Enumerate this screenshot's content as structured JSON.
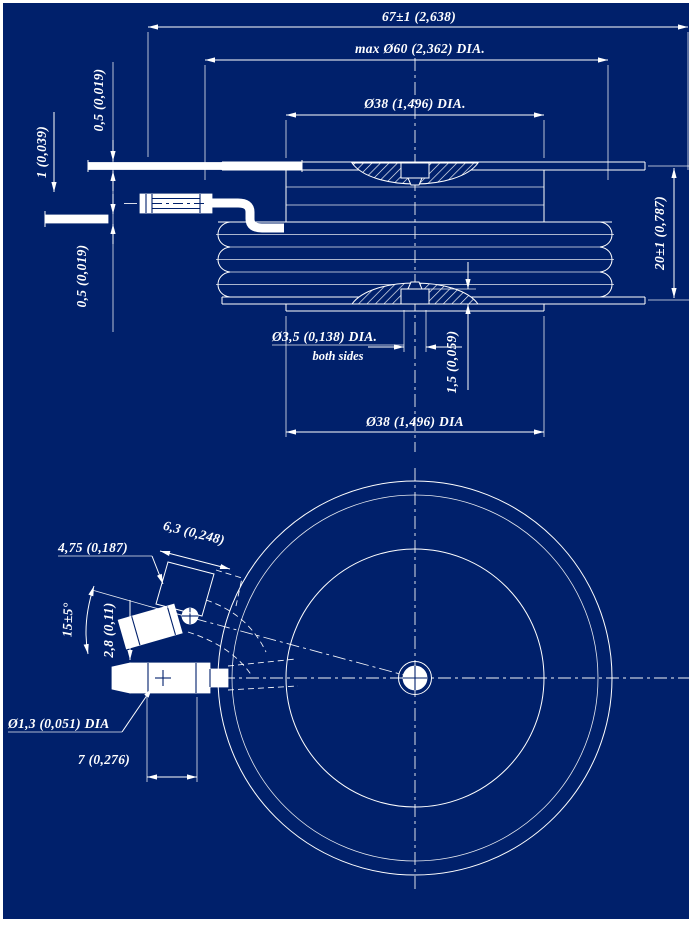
{
  "page": {
    "background_color": "#00206b",
    "line_color": "#ffffff",
    "description": "Dimensional outline drawing of disc-type (puck) semiconductor device with gate leads"
  },
  "side_view": {
    "labels": {
      "overall_width": "67±1 (2,638)",
      "max_diameter": "max Ø60 (2,362) DIA.",
      "top_pole_diameter": "Ø38 (1,496) DIA.",
      "upper_lead_thickness": "0,5 (0,019)",
      "lead_spacing": "1 (0,039)",
      "lower_lead_thickness": "0,5 (0,019)",
      "body_height": "20±1 (0,787)",
      "gate_hole_diameter": "Ø3,5 (0,138) DIA.",
      "gate_hole_note": "both sides",
      "recess_depth": "1,5 (0,059)",
      "bottom_pole_diameter": "Ø38 (1,496) DIA"
    }
  },
  "plan_view": {
    "labels": {
      "terminal_width": "4,75 (0,187)",
      "terminal_tab_size": "6,3 (0,248)",
      "lead_angle": "15±5°",
      "terminal_offset": "2,8 (0,11)",
      "wire_diameter": "Ø1,3 (0,051) DIA",
      "terminal_length": "7 (0,276)"
    }
  }
}
